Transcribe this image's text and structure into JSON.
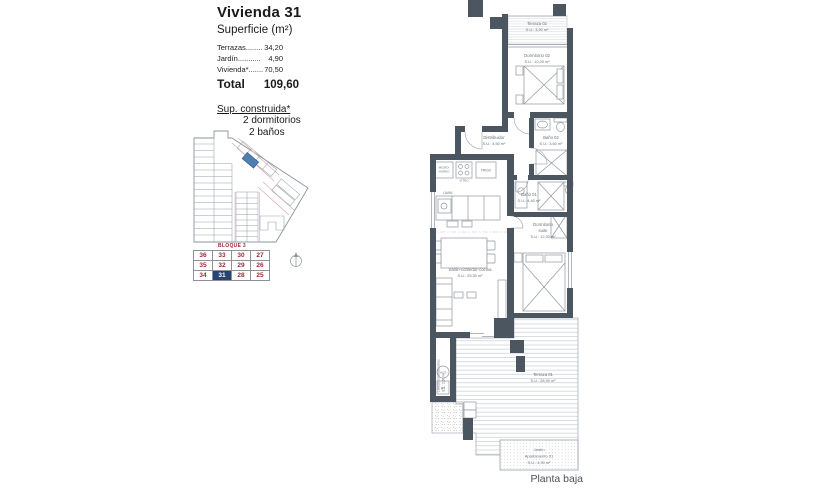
{
  "header": {
    "title": "Vivienda 31",
    "subtitle": "Superficie (m²)",
    "rows": [
      {
        "label": "Terrazas........",
        "value": "34,20"
      },
      {
        "label": "Jardín...........",
        "value": "4,90"
      },
      {
        "label": "Vivienda*.......",
        "value": "70,50"
      }
    ],
    "total_label": "Total",
    "total_value": "109,60",
    "built_heading": "Sup. construida*",
    "feature1": "2 dormitorios",
    "feature2": "2 baños"
  },
  "site_plan": {
    "block_label": "BLOQUE 3",
    "units": {
      "r0": [
        "36",
        "33",
        "30",
        "27"
      ],
      "r1": [
        "35",
        "32",
        "29",
        "26"
      ],
      "r2": [
        "34",
        "31",
        "28",
        "25"
      ]
    },
    "highlighted_unit": "31",
    "unit_number_color": "#9c2b33",
    "highlight_bg": "#274472",
    "highlighted_lot_fill": "#4f7fae",
    "street_color": "#dba8b2"
  },
  "floor_plan": {
    "caption": "Planta baja",
    "rooms": {
      "terraza02": {
        "name": "Terraza 02",
        "area": "S.U.: 3,90 m²"
      },
      "dormitorio02": {
        "name": "Dormitorio 02",
        "area": "S.U.: 10,00 m²"
      },
      "distribuidor": {
        "name": "Distribuidor",
        "area": "S.U.: 4,50 m²"
      },
      "bano02": {
        "name": "Baño 02",
        "area": "S.U.: 3,60 m²"
      },
      "bano01": {
        "name": "Baño 01",
        "area": "S.U.: 4,40 m²"
      },
      "suite": {
        "name": "Dormitorio",
        "name2": "suite",
        "area": "S.U.: 12,00 m²"
      },
      "salon": {
        "name": "Salón-comedor-cocina",
        "area": "S.U.: 25,50 m²"
      },
      "terraza01": {
        "name": "Terraza 01",
        "area": "S.U.: 28,90 m²"
      },
      "lavadero": {
        "name": "Lavadero/instalaciones",
        "area": "S.U.: 2,50 m²"
      },
      "jardin": {
        "name": "Jardín",
        "name2": "Apartamento 31",
        "area": "S.U.: 4,90 m²"
      }
    },
    "labels": {
      "micro1": "MICRO/",
      "micro2": "HORNO",
      "vitro": "VITRO",
      "frigo": "FRIGO",
      "lavav": "LAVAV.",
      "acs": "ACS",
      "bt": "BT"
    }
  }
}
